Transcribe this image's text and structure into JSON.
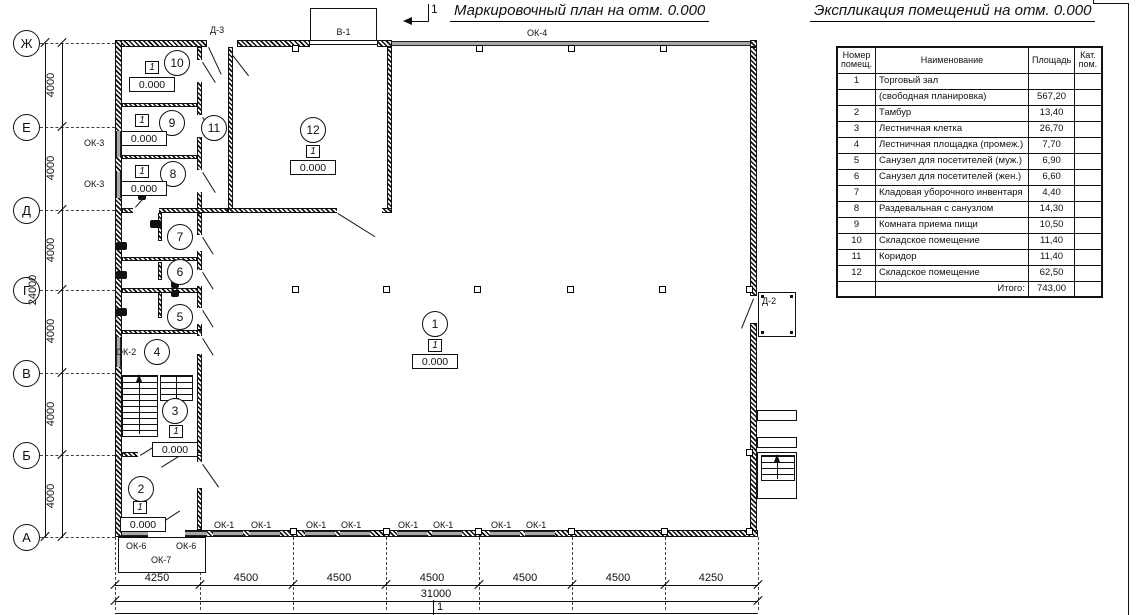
{
  "plan": {
    "title": "Маркировочный план на отм. 0.000",
    "section_mark": "1",
    "marks": {
      "type": "1",
      "level": "0.000"
    },
    "room_numbers": [
      "1",
      "2",
      "3",
      "4",
      "5",
      "6",
      "7",
      "8",
      "9",
      "10",
      "11",
      "12"
    ],
    "axes": {
      "rows": [
        "Ж",
        "Е",
        "Д",
        "Г",
        "В",
        "Б",
        "А"
      ],
      "row_dim": "4000",
      "row_total": "24000",
      "col_dims": [
        "4250",
        "4500",
        "4500",
        "4500",
        "4500",
        "4500",
        "4250"
      ],
      "col_total": "31000"
    },
    "openings": {
      "ok1": "ОК-1",
      "ok2": "ОК-2",
      "ok3": "ОК-3",
      "ok4": "ОК-4",
      "ok6": "ОК-6",
      "ok7": "ОК-7",
      "d1": "Д-1",
      "d2": "Д-2",
      "d3": "Д-3",
      "v1": "В-1"
    }
  },
  "schedule": {
    "title": "Экспликация помещений на отм. 0.000",
    "headers": {
      "num": "Номер помещ.",
      "name": "Наименование",
      "area": "Площадь",
      "cat": "Кат. пом."
    },
    "rows": [
      {
        "num": "1",
        "name": "Торговый зал",
        "area": "",
        "cat": ""
      },
      {
        "num": "",
        "name": "(свободная планировка)",
        "area": "567,20",
        "cat": ""
      },
      {
        "num": "2",
        "name": "Тамбур",
        "area": "13,40",
        "cat": ""
      },
      {
        "num": "3",
        "name": "Лестничная клетка",
        "area": "26,70",
        "cat": ""
      },
      {
        "num": "4",
        "name": "Лестничная площадка (промеж.)",
        "area": "7,70",
        "cat": ""
      },
      {
        "num": "5",
        "name": "Санузел для посетителей (муж.)",
        "area": "6,90",
        "cat": ""
      },
      {
        "num": "6",
        "name": "Санузел для посетителей (жен.)",
        "area": "6,60",
        "cat": ""
      },
      {
        "num": "7",
        "name": "Кладовая уборочного инвентаря",
        "area": "4,40",
        "cat": ""
      },
      {
        "num": "8",
        "name": "Раздевальная с санузлом",
        "area": "14,30",
        "cat": ""
      },
      {
        "num": "9",
        "name": "Комната приема пищи",
        "area": "10,50",
        "cat": ""
      },
      {
        "num": "10",
        "name": "Складское помещение",
        "area": "11,40",
        "cat": ""
      },
      {
        "num": "11",
        "name": "Коридор",
        "area": "11,40",
        "cat": ""
      },
      {
        "num": "12",
        "name": "Складское помещение",
        "area": "62,50",
        "cat": ""
      }
    ],
    "total": {
      "label": "Итого:",
      "value": "743,00"
    }
  },
  "colors": {
    "line": "#1a1a1a",
    "window": "#a8a8a8"
  }
}
